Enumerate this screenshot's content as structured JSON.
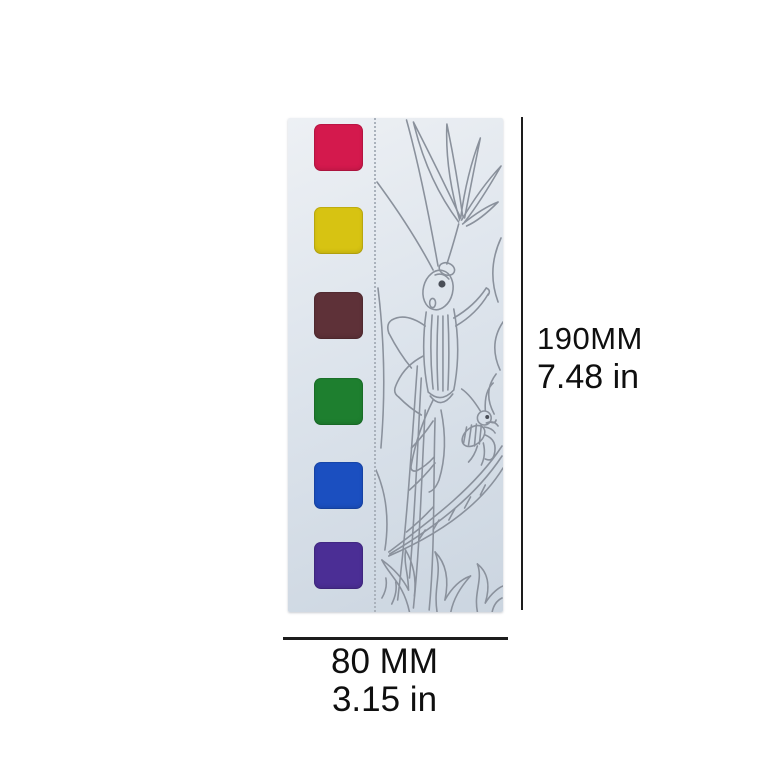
{
  "product": {
    "type": "watercolor paint strip with coloring outline",
    "illustration": "grasshopper and plants line art",
    "strip_bg_top": "#edf0f4",
    "strip_bg_bottom": "#cbd5e0",
    "sketch_color": "#8a919c",
    "perforation_color": "#aab2bc",
    "swatches": [
      {
        "name": "crimson",
        "color": "#d4194d"
      },
      {
        "name": "yellow",
        "color": "#d7c312"
      },
      {
        "name": "maroon",
        "color": "#5e3138"
      },
      {
        "name": "green",
        "color": "#1e7f2f"
      },
      {
        "name": "blue",
        "color": "#1b4fc0"
      },
      {
        "name": "purple",
        "color": "#4b2e95"
      }
    ]
  },
  "annotations": {
    "line_color": "#1d1d1d",
    "height": {
      "metric": "190MM",
      "imperial": "7.48 in"
    },
    "width": {
      "metric": "80 MM",
      "imperial": "3.15 in"
    }
  }
}
